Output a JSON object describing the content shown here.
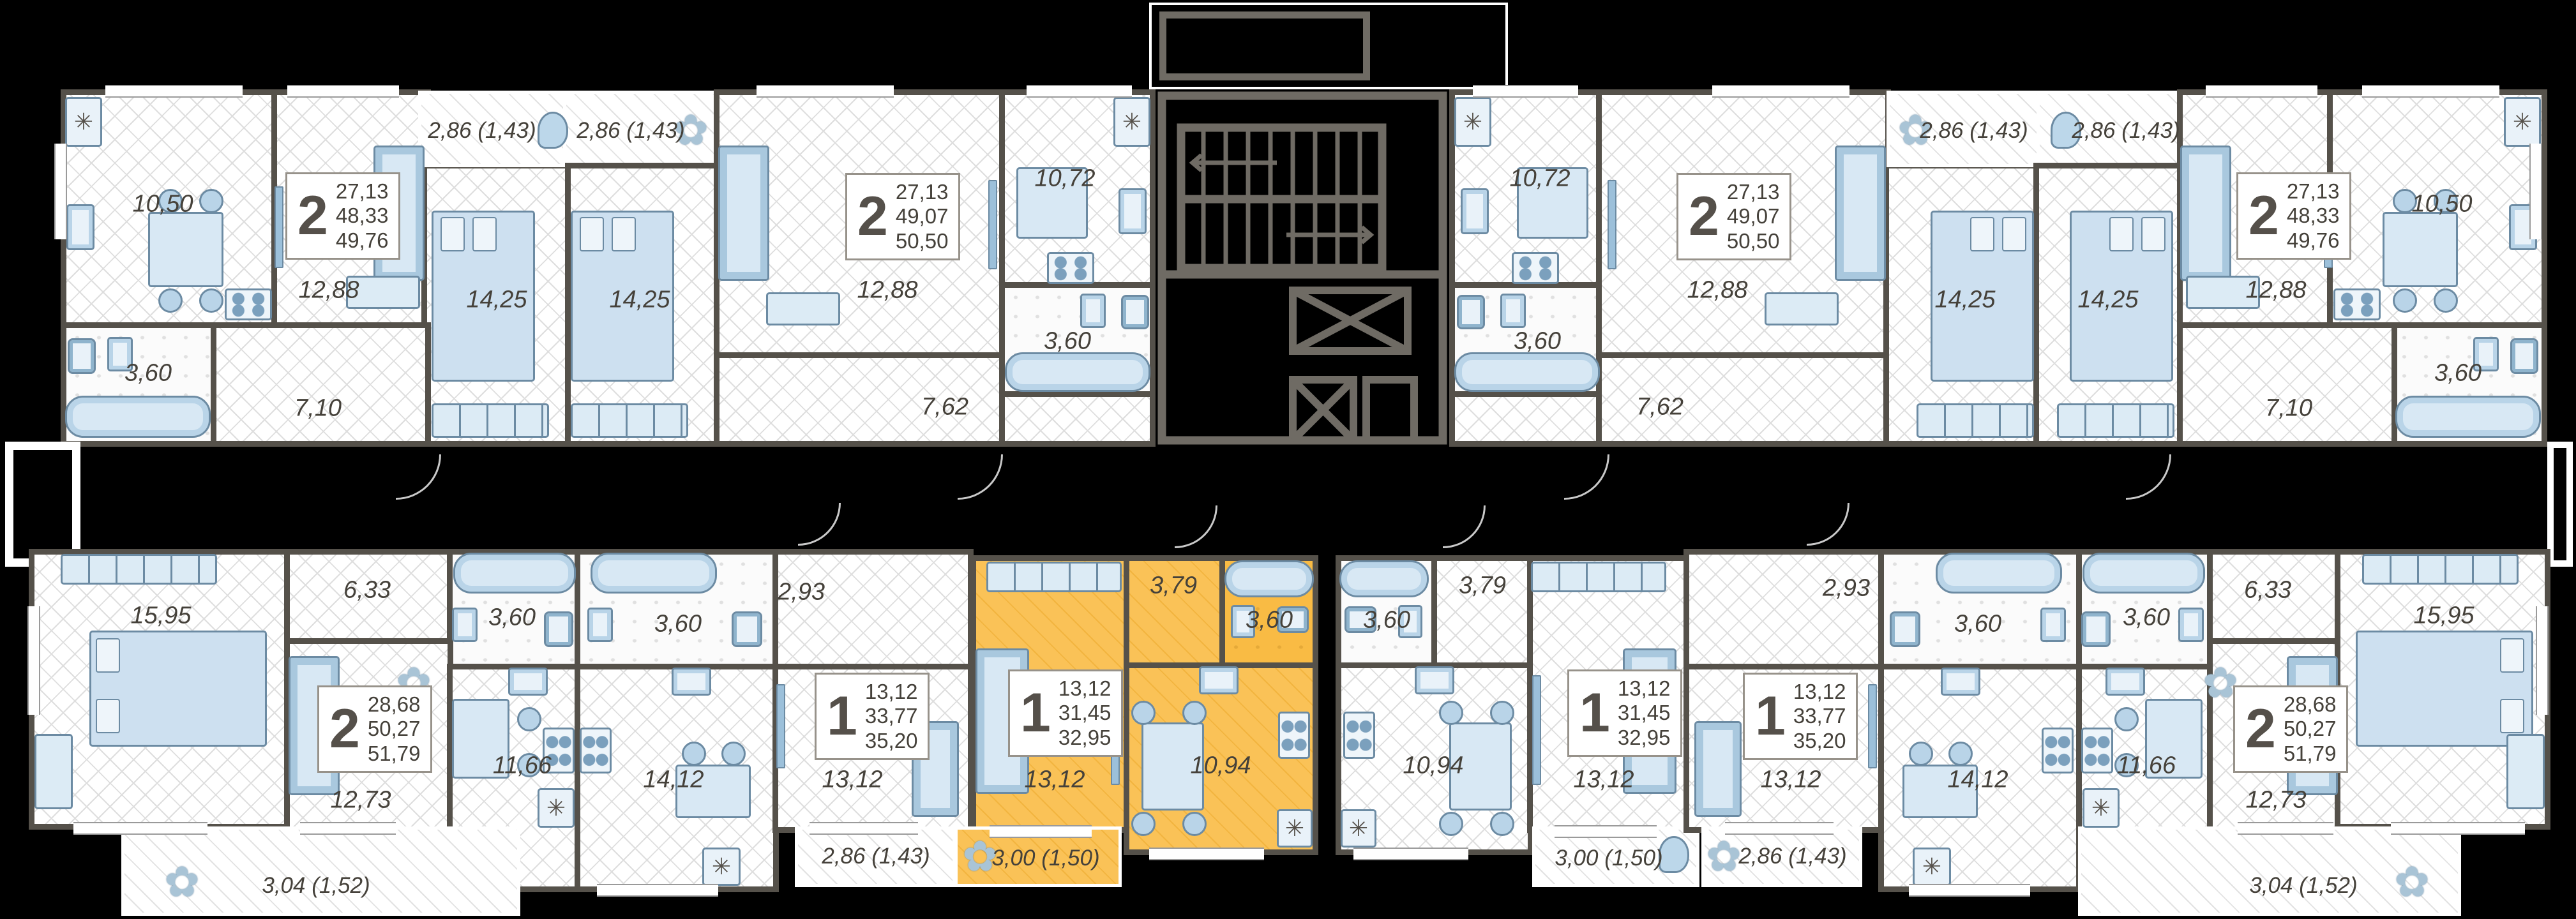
{
  "colors": {
    "background": "#000000",
    "wall": "#55514a",
    "highlight": "#f9bb44",
    "floor": "#ffffff",
    "floor_hatch": "#dedede",
    "furniture_fill": "#d8e8f4",
    "furniture_line": "#6c8ba3",
    "label_text": "#45413a",
    "core_line": "#6f6b64"
  },
  "icons": {
    "fridge": "✳",
    "plant": "✿"
  },
  "core": {
    "stairs": "stairwell",
    "elevators": 2
  },
  "units": [
    {
      "id": "t1",
      "card": {
        "rooms": "2",
        "living_area": "27,13",
        "area": "48,33",
        "total_area": "49,76"
      },
      "rooms": {
        "kitchen": "10,50",
        "living": "12,88",
        "bedroom": "14,25",
        "bathroom": "3,60",
        "hallway": "7,10"
      },
      "balcony": "2,86 (1,43)",
      "highlighted": false
    },
    {
      "id": "t2",
      "card": {
        "rooms": "2",
        "living_area": "27,13",
        "area": "49,07",
        "total_area": "50,50"
      },
      "rooms": {
        "bedroom": "14,25",
        "living": "12,88",
        "kitchen": "10,72",
        "bathroom": "3,60",
        "hallway": "7,62"
      },
      "balcony": "2,86 (1,43)",
      "highlighted": false
    },
    {
      "id": "t3",
      "card": {
        "rooms": "2",
        "living_area": "27,13",
        "area": "49,07",
        "total_area": "50,50"
      },
      "rooms": {
        "bedroom": "14,25",
        "living": "12,88",
        "kitchen": "10,72",
        "bathroom": "3,60",
        "hallway": "7,62"
      },
      "balcony": "2,86 (1,43)",
      "highlighted": false
    },
    {
      "id": "t4",
      "card": {
        "rooms": "2",
        "living_area": "27,13",
        "area": "48,33",
        "total_area": "49,76"
      },
      "rooms": {
        "kitchen": "10,50",
        "living": "12,88",
        "bedroom": "14,25",
        "bathroom": "3,60",
        "hallway": "7,10"
      },
      "balcony": "2,86 (1,43)",
      "highlighted": false
    },
    {
      "id": "b1",
      "card": {
        "rooms": "2",
        "living_area": "28,68",
        "area": "50,27",
        "total_area": "51,79"
      },
      "rooms": {
        "bedroom": "15,95",
        "hallway": "6,33",
        "bathroom": "3,60",
        "living": "12,73",
        "kitchen": "11,66"
      },
      "balcony": "3,04 (1,52)",
      "highlighted": false
    },
    {
      "id": "b2",
      "card": {
        "rooms": "1",
        "living_area": "13,12",
        "area": "33,77",
        "total_area": "35,20"
      },
      "rooms": {
        "bathroom": "3,60",
        "hallway": "2,93",
        "kitchen": "14,12",
        "room": "13,12"
      },
      "balcony": "2,86 (1,43)",
      "highlighted": false
    },
    {
      "id": "b3",
      "card": {
        "rooms": "1",
        "living_area": "13,12",
        "area": "31,45",
        "total_area": "32,95"
      },
      "rooms": {
        "room": "13,12",
        "hallway": "3,79",
        "bathroom": "3,60",
        "kitchen": "10,94"
      },
      "balcony": "3,00 (1,50)",
      "highlighted": true
    },
    {
      "id": "b4",
      "card": {
        "rooms": "1",
        "living_area": "13,12",
        "area": "31,45",
        "total_area": "32,95"
      },
      "rooms": {
        "room": "13,12",
        "hallway": "3,79",
        "bathroom": "3,60",
        "kitchen": "10,94"
      },
      "balcony": "3,00 (1,50)",
      "highlighted": false
    },
    {
      "id": "b5",
      "card": {
        "rooms": "1",
        "living_area": "13,12",
        "area": "33,77",
        "total_area": "35,20"
      },
      "rooms": {
        "bathroom": "3,60",
        "hallway": "2,93",
        "kitchen": "14,12",
        "room": "13,12"
      },
      "balcony": "2,86 (1,43)",
      "highlighted": false
    },
    {
      "id": "b6",
      "card": {
        "rooms": "2",
        "living_area": "28,68",
        "area": "50,27",
        "total_area": "51,79"
      },
      "rooms": {
        "bedroom": "15,95",
        "hallway": "6,33",
        "bathroom": "3,60",
        "living": "12,73",
        "kitchen": "11,66"
      },
      "balcony": "3,04 (1,52)",
      "highlighted": false
    }
  ]
}
